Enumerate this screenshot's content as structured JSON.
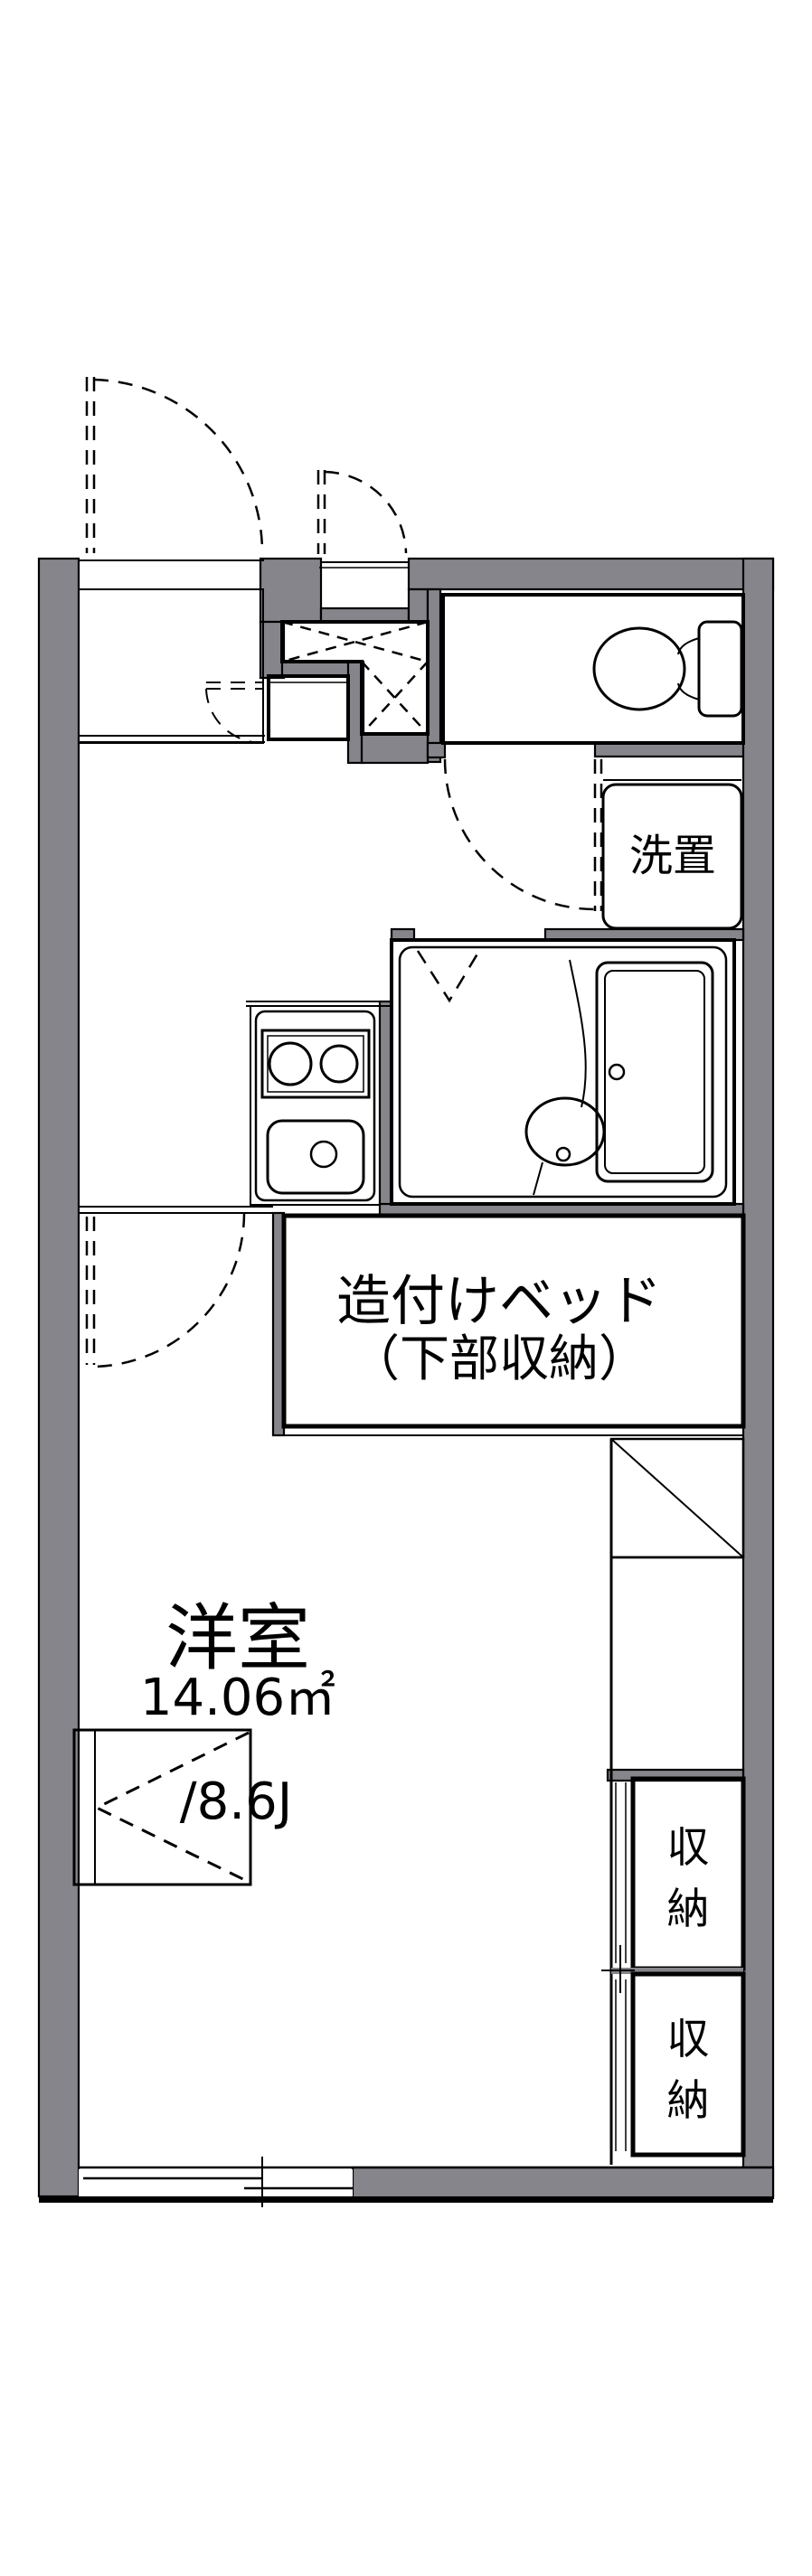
{
  "palette": {
    "wall_gray": "#85858b",
    "room_blue": "#dbe7f8",
    "storage_cream": "#fcf2dd",
    "line_black": "#000000",
    "bg": "#ffffff"
  },
  "plan": {
    "main_room": {
      "name": "洋室",
      "area_m2": "14.06㎡",
      "area_jo": "/8.6J"
    },
    "built_in_bed": {
      "line1": "造付けベッド",
      "line2": "（下部収納）"
    },
    "washer_space": {
      "label": "洗置"
    },
    "storage": {
      "chars": [
        "収",
        "納"
      ]
    }
  }
}
